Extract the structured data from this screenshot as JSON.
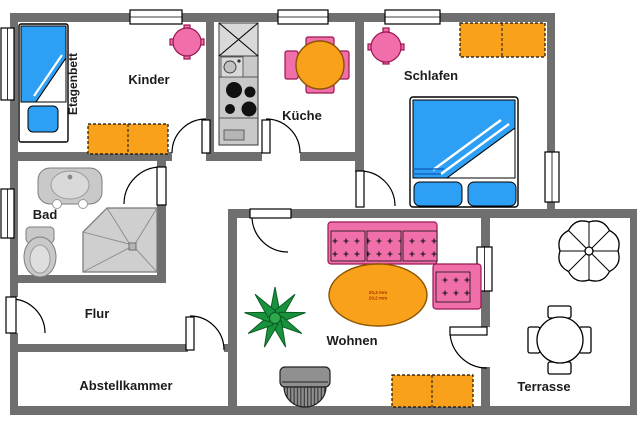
{
  "rooms": {
    "kinder": {
      "label": "Kinder"
    },
    "etagenbett": {
      "label": "Etagenbett"
    },
    "kueche": {
      "label": "Küche"
    },
    "schlafen": {
      "label": "Schlafen"
    },
    "bad": {
      "label": "Bad"
    },
    "flur": {
      "label": "Flur"
    },
    "abstellkammer": {
      "label": "Abstellkammer"
    },
    "wohnen": {
      "label": "Wohnen"
    },
    "terrasse": {
      "label": "Terrasse"
    }
  },
  "annotations": {
    "coffee_table": [
      "20,3 mm",
      "20,2 mm"
    ]
  },
  "colors": {
    "wall": "#6f6f6f",
    "blue": "#2d9ff4",
    "orange": "#f9a11b",
    "pink": "#f06fab",
    "pink_border": "#99164f",
    "gray": "#c9c9c9",
    "gray_border": "#7d7d7d",
    "green": "#18923c",
    "green_dark": "#0a5c22",
    "tv": "#909090",
    "text": "#1c1c1c",
    "annotation": "#b03000"
  }
}
